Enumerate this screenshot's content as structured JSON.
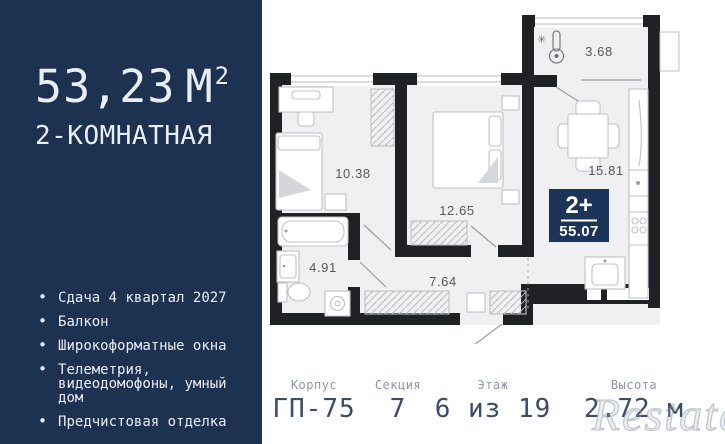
{
  "panel": {
    "area_value": "53,23",
    "area_unit": "М",
    "area_sup": "2",
    "type_label": "2-КОМНАТНАЯ",
    "features": [
      {
        "text": "Сдача 4 квартал 2027"
      },
      {
        "text": "Балкон"
      },
      {
        "text": "Широкоформатные окна"
      },
      {
        "text": "Телеметрия,\nвидеодомофоны, умный\nдом"
      },
      {
        "text": "Предчистовая отделка"
      }
    ]
  },
  "plan": {
    "areas": {
      "balcony": "3.68",
      "bedroom1": "10.38",
      "bedroom2": "12.65",
      "kitchen": "15.81",
      "bathroom": "4.91",
      "hallway": "7.64"
    },
    "badge": {
      "rooms_label": "2+",
      "total_area": "55.07"
    }
  },
  "details": {
    "columns": [
      {
        "label": "Корпус",
        "value": "ГП-75"
      },
      {
        "label": "Секция",
        "value": "7"
      },
      {
        "label": "Этаж",
        "value": "6 из 19"
      },
      {
        "label": "Высота",
        "value": "2.72 м"
      }
    ]
  },
  "icons": {
    "bullet": "•",
    "snowflake": "✳"
  },
  "watermark": "Restate",
  "colors": {
    "panel_navy": "#1d3150",
    "badge_navy": "#1c3457",
    "wall_black": "#202125",
    "room_fill": "#f0f0f2",
    "value_navy": "#3b4c68",
    "label_gray": "#8f97a6"
  }
}
